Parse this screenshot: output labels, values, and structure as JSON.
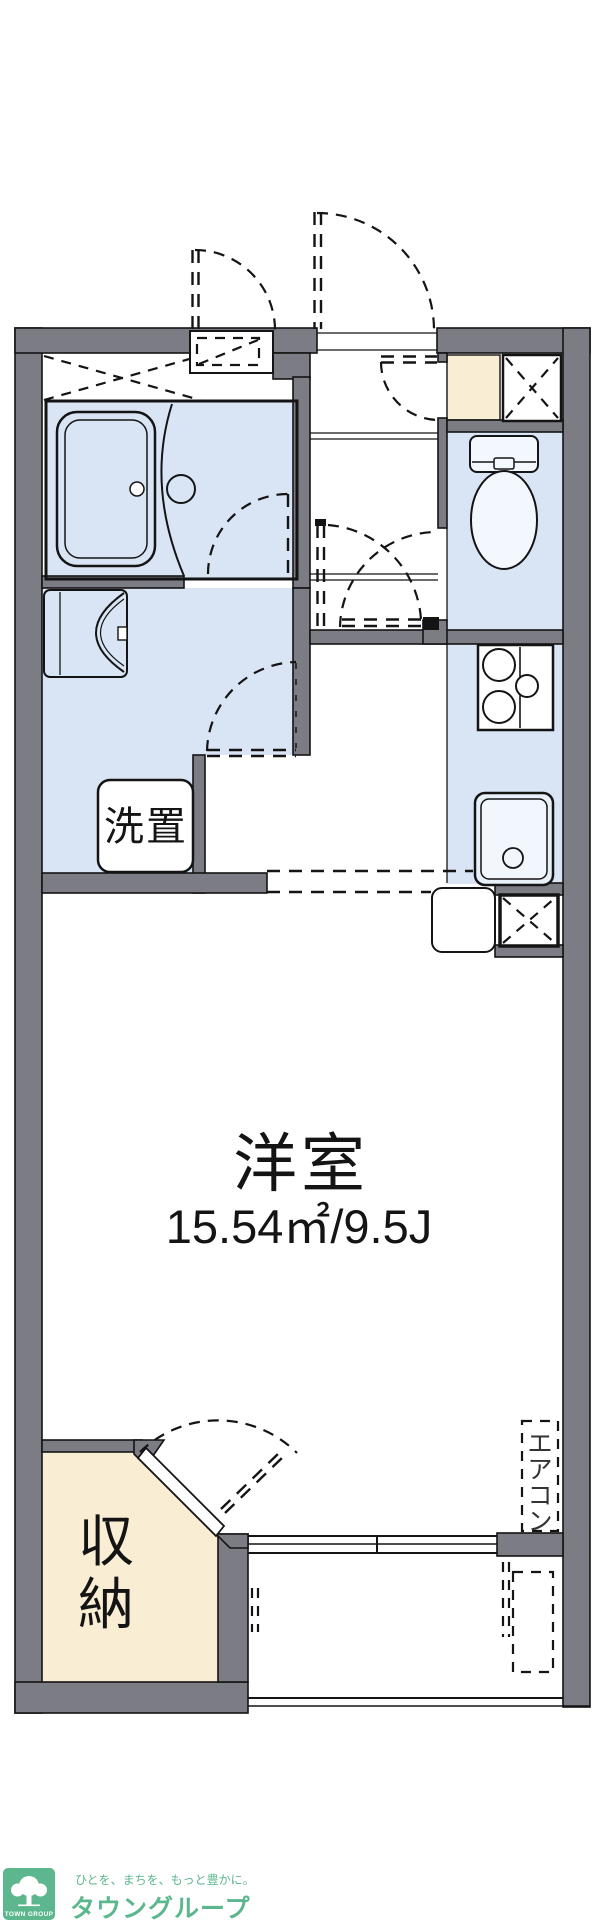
{
  "labels": {
    "main_room": "洋室",
    "main_room_size": "15.54㎡/9.5J",
    "washer": "洗置",
    "storage_chars": [
      "収",
      "納"
    ],
    "aircon_chars": [
      "エ",
      "ア",
      "コ",
      "ン"
    ]
  },
  "logo": {
    "tagline": "ひとを、まちを、もっと豊かに。",
    "brand": "タウングループ",
    "badge": "TOWN GROUP",
    "icon": "tree-icon"
  },
  "colors": {
    "wall": "#7c7c85",
    "floor": "#d9e5f5",
    "cream": "#f9edd4",
    "line": "#141414",
    "brand_green": "#5cb78e"
  }
}
